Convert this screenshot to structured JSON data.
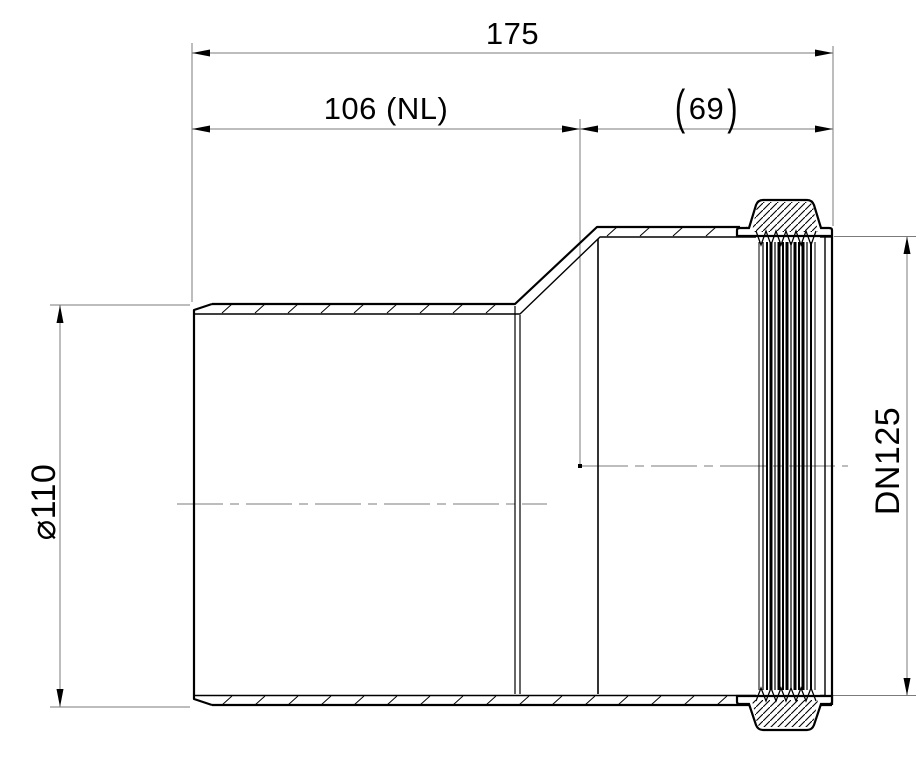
{
  "drawing": {
    "labels": {
      "overall_length": "175",
      "net_length": "106 (NL)",
      "socket_open": "(",
      "socket_value": "69",
      "socket_close": ")",
      "outer_diameter": "⌀110",
      "nominal_size": "DN125"
    },
    "dimensions": [
      {
        "name": "overall-length",
        "text": "175"
      },
      {
        "name": "net-length",
        "text": "106 (NL)"
      },
      {
        "name": "socket-depth",
        "text": "(69)",
        "auxiliary": true
      },
      {
        "name": "spigot-outer-diameter",
        "text": "⌀110"
      },
      {
        "name": "socket-nominal-diameter",
        "text": "DN125"
      }
    ],
    "colors": {
      "edge": "#000000",
      "dimension_lines": "#7b7b7b",
      "background": "#ffffff"
    }
  }
}
